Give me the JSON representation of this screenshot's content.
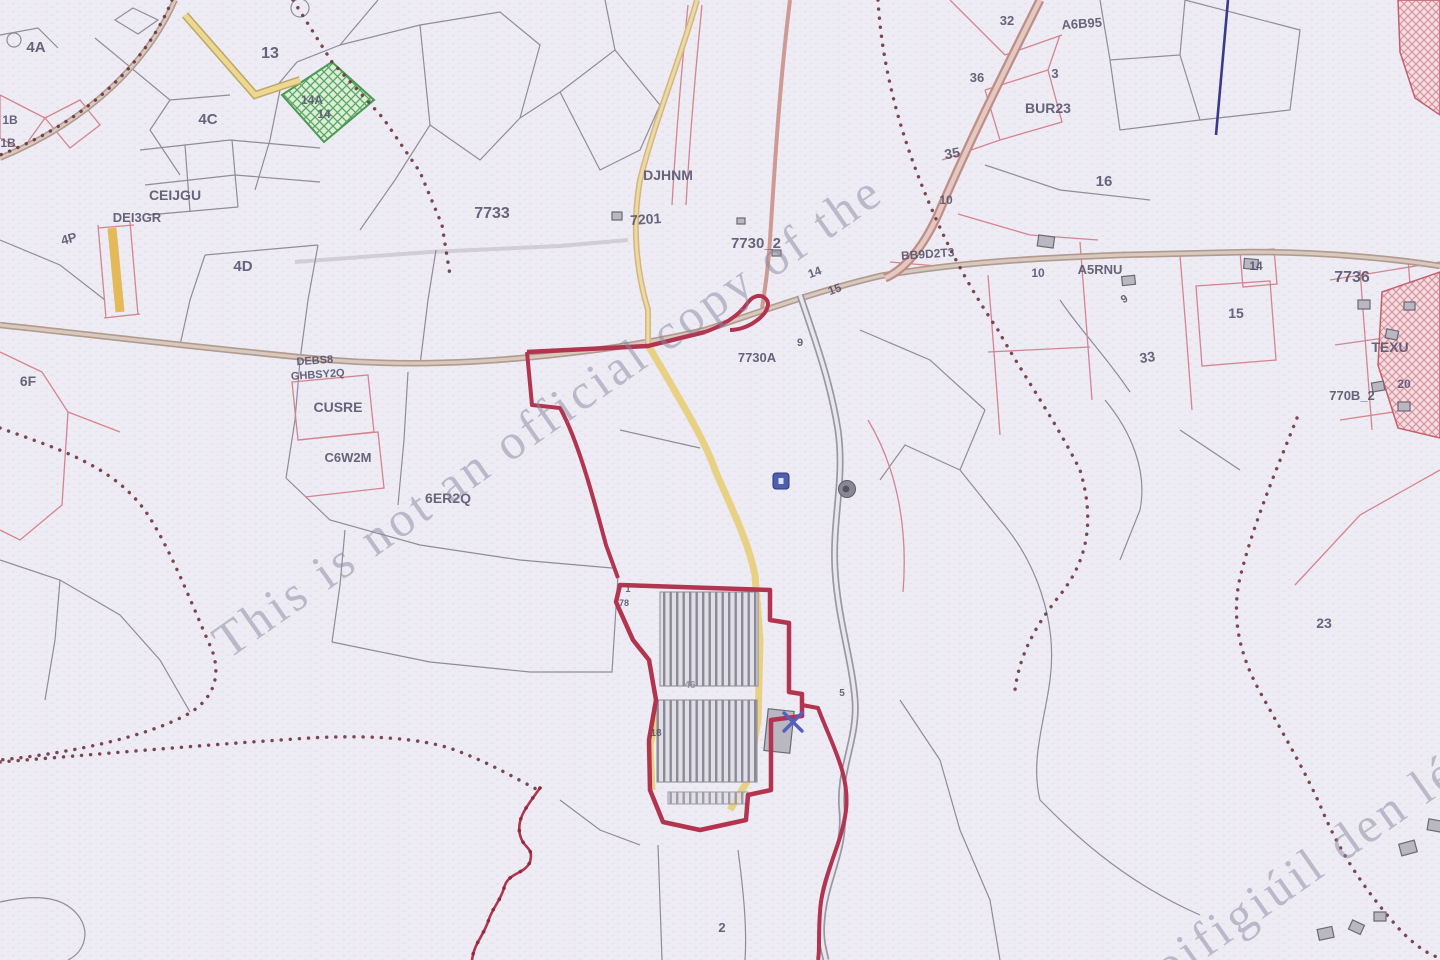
{
  "map": {
    "type": "cadastral-scanned-map",
    "watermark": {
      "english": "This is not an official copy of the",
      "irish": "oifigiúil den lé"
    },
    "colors": {
      "background": "#edebf3",
      "boundary_crimson": "#b2344f",
      "townland_dot": "#6e3340",
      "road_brown": "#b29a8f",
      "road_tan": "#d5b67c",
      "road_yellow": "#e8d07e",
      "parcel_gray": "#8f8c99",
      "parcel_pink": "#d4848f",
      "green_parcel": "#4a9a55",
      "label_ink": "#55516b",
      "watermark_ink": "#8b89a0",
      "blue_feature": "#3a3a8c"
    },
    "labels": [
      {
        "t": "4A",
        "x": 36,
        "y": 52,
        "s": 15
      },
      {
        "t": "13",
        "x": 270,
        "y": 58,
        "s": 16
      },
      {
        "t": "4C",
        "x": 208,
        "y": 124,
        "s": 15
      },
      {
        "t": "14A",
        "x": 312,
        "y": 104,
        "s": 12
      },
      {
        "t": "14",
        "x": 324,
        "y": 118,
        "s": 12
      },
      {
        "t": "1B",
        "x": 10,
        "y": 124,
        "s": 12
      },
      {
        "t": "1B",
        "x": 8,
        "y": 147,
        "s": 12
      },
      {
        "t": "4P",
        "x": 70,
        "y": 243,
        "s": 13,
        "r": -15
      },
      {
        "t": "DEI3GR",
        "x": 137,
        "y": 222,
        "s": 13
      },
      {
        "t": "CEIJGU",
        "x": 175,
        "y": 200,
        "s": 14
      },
      {
        "t": "4D",
        "x": 243,
        "y": 271,
        "s": 15
      },
      {
        "t": "6F",
        "x": 28,
        "y": 386,
        "s": 14
      },
      {
        "t": "7733",
        "x": 492,
        "y": 218,
        "s": 16
      },
      {
        "t": "DJHNM",
        "x": 668,
        "y": 180,
        "s": 14
      },
      {
        "t": "7201",
        "x": 646,
        "y": 224,
        "s": 14,
        "r": -4
      },
      {
        "t": "7730_2",
        "x": 756,
        "y": 248,
        "s": 15
      },
      {
        "t": "14",
        "x": 816,
        "y": 276,
        "s": 12,
        "r": -20
      },
      {
        "t": "15",
        "x": 836,
        "y": 293,
        "s": 12,
        "r": -20
      },
      {
        "t": "9",
        "x": 800,
        "y": 346,
        "s": 11
      },
      {
        "t": "7730A",
        "x": 757,
        "y": 362,
        "s": 13
      },
      {
        "t": "DEBS8",
        "x": 315,
        "y": 364,
        "s": 11,
        "r": -4
      },
      {
        "t": "GHBSY2Q",
        "x": 318,
        "y": 378,
        "s": 11,
        "r": -4
      },
      {
        "t": "CUSRE",
        "x": 338,
        "y": 412,
        "s": 14
      },
      {
        "t": "C6W2M",
        "x": 348,
        "y": 462,
        "s": 13
      },
      {
        "t": "6ER2Q",
        "x": 448,
        "y": 503,
        "s": 14
      },
      {
        "t": "32",
        "x": 1007,
        "y": 25,
        "s": 13
      },
      {
        "t": "A6B95",
        "x": 1082,
        "y": 28,
        "s": 13,
        "r": -4
      },
      {
        "t": "36",
        "x": 977,
        "y": 82,
        "s": 13
      },
      {
        "t": "3",
        "x": 1055,
        "y": 78,
        "s": 13
      },
      {
        "t": "BUR23",
        "x": 1048,
        "y": 113,
        "s": 14
      },
      {
        "t": "35",
        "x": 953,
        "y": 158,
        "s": 14,
        "r": -10
      },
      {
        "t": "16",
        "x": 1104,
        "y": 186,
        "s": 15
      },
      {
        "t": "10",
        "x": 946,
        "y": 204,
        "s": 12
      },
      {
        "t": "BB9D2T3",
        "x": 928,
        "y": 258,
        "s": 12,
        "r": -4
      },
      {
        "t": "10",
        "x": 1038,
        "y": 277,
        "s": 12
      },
      {
        "t": "A5RNU",
        "x": 1100,
        "y": 274,
        "s": 13
      },
      {
        "t": "9",
        "x": 1126,
        "y": 302,
        "s": 11,
        "r": -30
      },
      {
        "t": "14",
        "x": 1256,
        "y": 270,
        "s": 12
      },
      {
        "t": "7736",
        "x": 1352,
        "y": 282,
        "s": 16
      },
      {
        "t": "15",
        "x": 1236,
        "y": 318,
        "s": 14
      },
      {
        "t": "33",
        "x": 1148,
        "y": 362,
        "s": 14,
        "r": -8
      },
      {
        "t": "TEXU",
        "x": 1390,
        "y": 352,
        "s": 14
      },
      {
        "t": "20",
        "x": 1404,
        "y": 388,
        "s": 12
      },
      {
        "t": "770B_2",
        "x": 1352,
        "y": 400,
        "s": 13
      },
      {
        "t": "23",
        "x": 1324,
        "y": 628,
        "s": 14
      },
      {
        "t": "5",
        "x": 842,
        "y": 696,
        "s": 10
      },
      {
        "t": "1",
        "x": 628,
        "y": 592,
        "s": 9
      },
      {
        "t": "78",
        "x": 624,
        "y": 606,
        "s": 9
      },
      {
        "t": "46",
        "x": 690,
        "y": 688,
        "s": 10,
        "c": "#8f8c9c"
      },
      {
        "t": "18",
        "x": 656,
        "y": 736,
        "s": 10
      },
      {
        "t": "2",
        "x": 722,
        "y": 932,
        "s": 13
      }
    ],
    "icons": [
      {
        "name": "blue-square-marker-icon",
        "type": "square",
        "x": 781,
        "y": 481
      },
      {
        "name": "gray-circle-marker-icon",
        "type": "circle",
        "x": 847,
        "y": 489
      },
      {
        "name": "blue-cross-marker-icon",
        "type": "cross",
        "x": 793,
        "y": 722
      }
    ]
  }
}
